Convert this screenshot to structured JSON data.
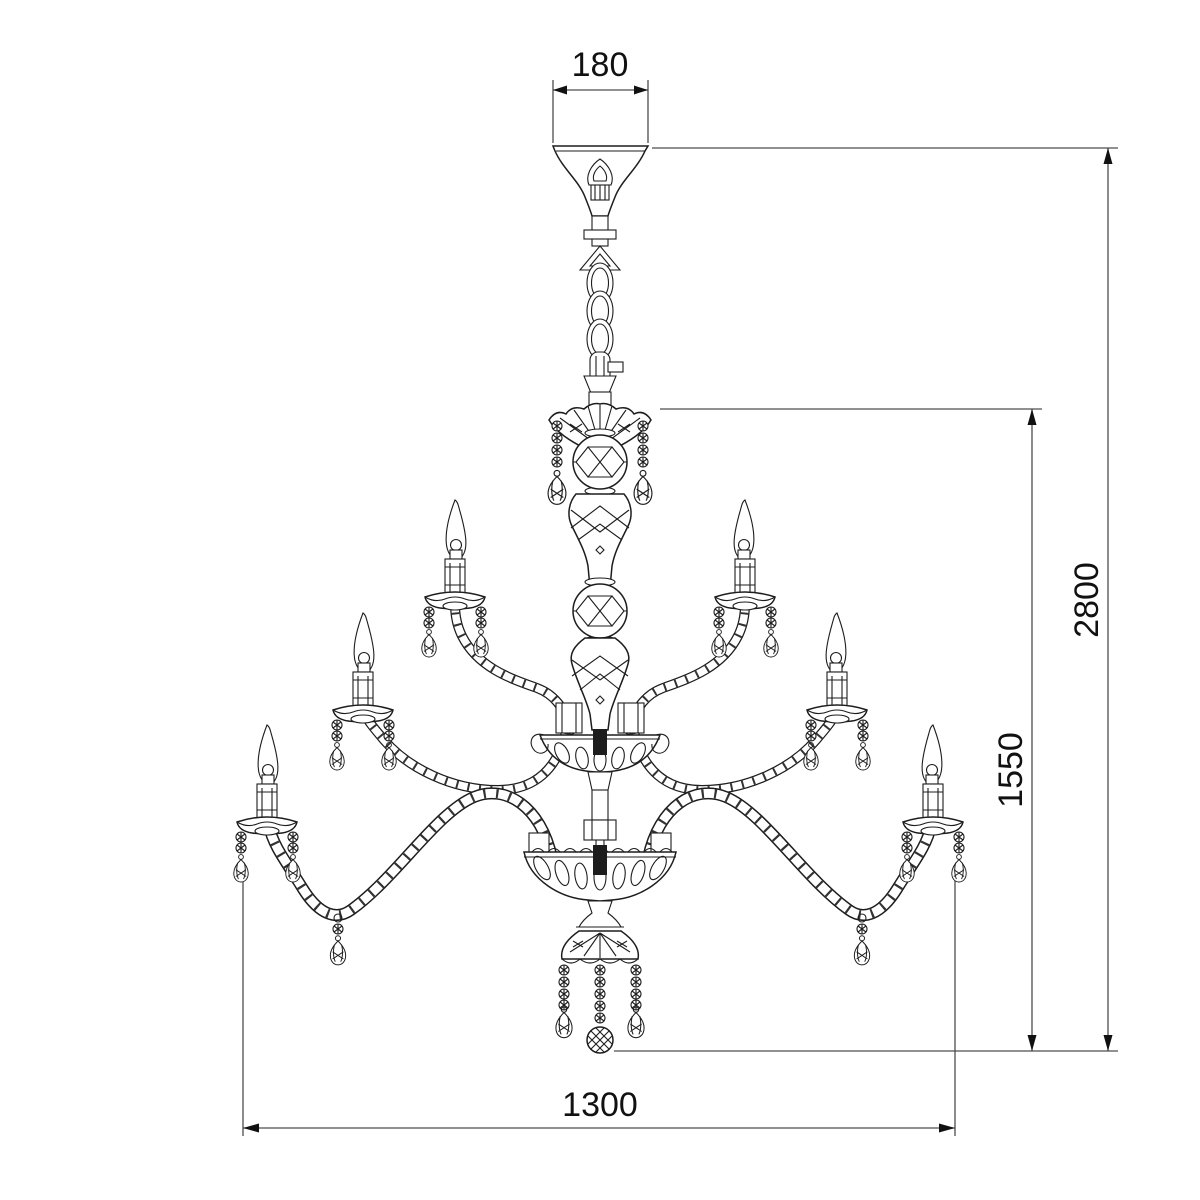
{
  "drawing": {
    "kind": "dimensioned technical elevation",
    "subject": "two-tier crystal chandelier with candle arms, suspension chain and ceiling canopy",
    "dimensions": {
      "canopy_width_label": "180",
      "overall_drop_label": "2800",
      "body_height_label": "1550",
      "body_width_label": "1300"
    },
    "style": {
      "background": "#ffffff",
      "line_color": "#1d1d1d",
      "dimension_color": "#4d4d4d",
      "text_color": "#111111"
    }
  }
}
